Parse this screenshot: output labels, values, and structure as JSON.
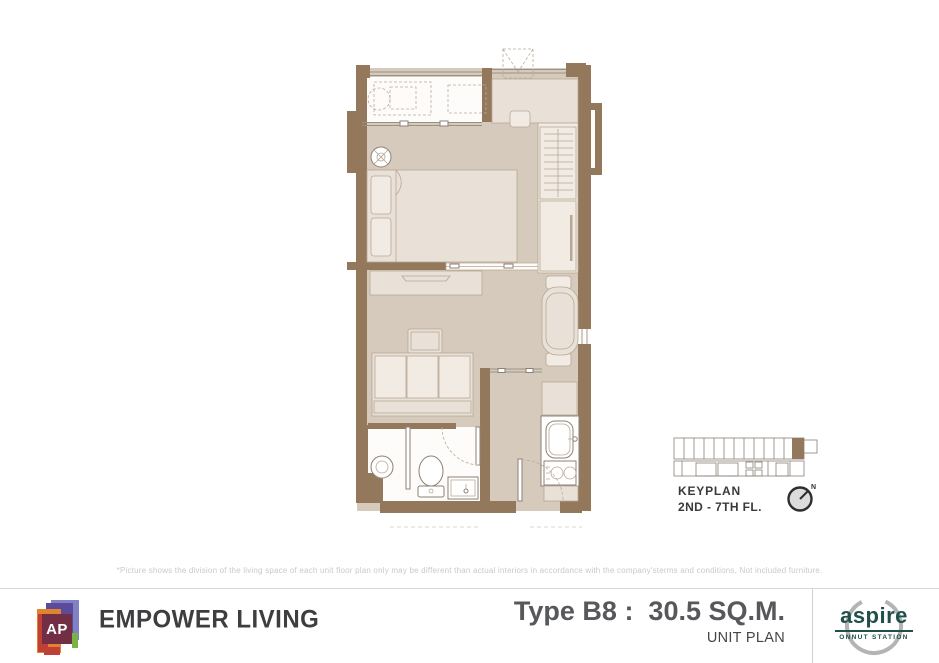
{
  "disclaimer": "*Picture shows the division of the living space of each unit floor plan only may be different than actual interiors in accordance with the company'sterms and conditions, Not included furniture.",
  "keyplan": {
    "title": "KEYPLAN",
    "floors": "2ND - 7TH FL.",
    "north": "N"
  },
  "footer": {
    "ap_logo": "AP",
    "brand": "EMPOWER LIVING",
    "unit_type": "Type B8 :  30.5 SQ.M.",
    "plan_label": "UNIT PLAN",
    "aspire_brand": "aspire",
    "aspire_location": "ONNUT STATION"
  },
  "colors": {
    "wall": "#93785c",
    "floor": "#d6cabc",
    "furniture": "#e9e1d7",
    "furniture_stroke": "#b7a795",
    "aspire_teal": "#21504b",
    "brand_ink": "#3e3e40",
    "title_gray": "#57585b",
    "disclaimer_gray": "#c9c9c9"
  }
}
